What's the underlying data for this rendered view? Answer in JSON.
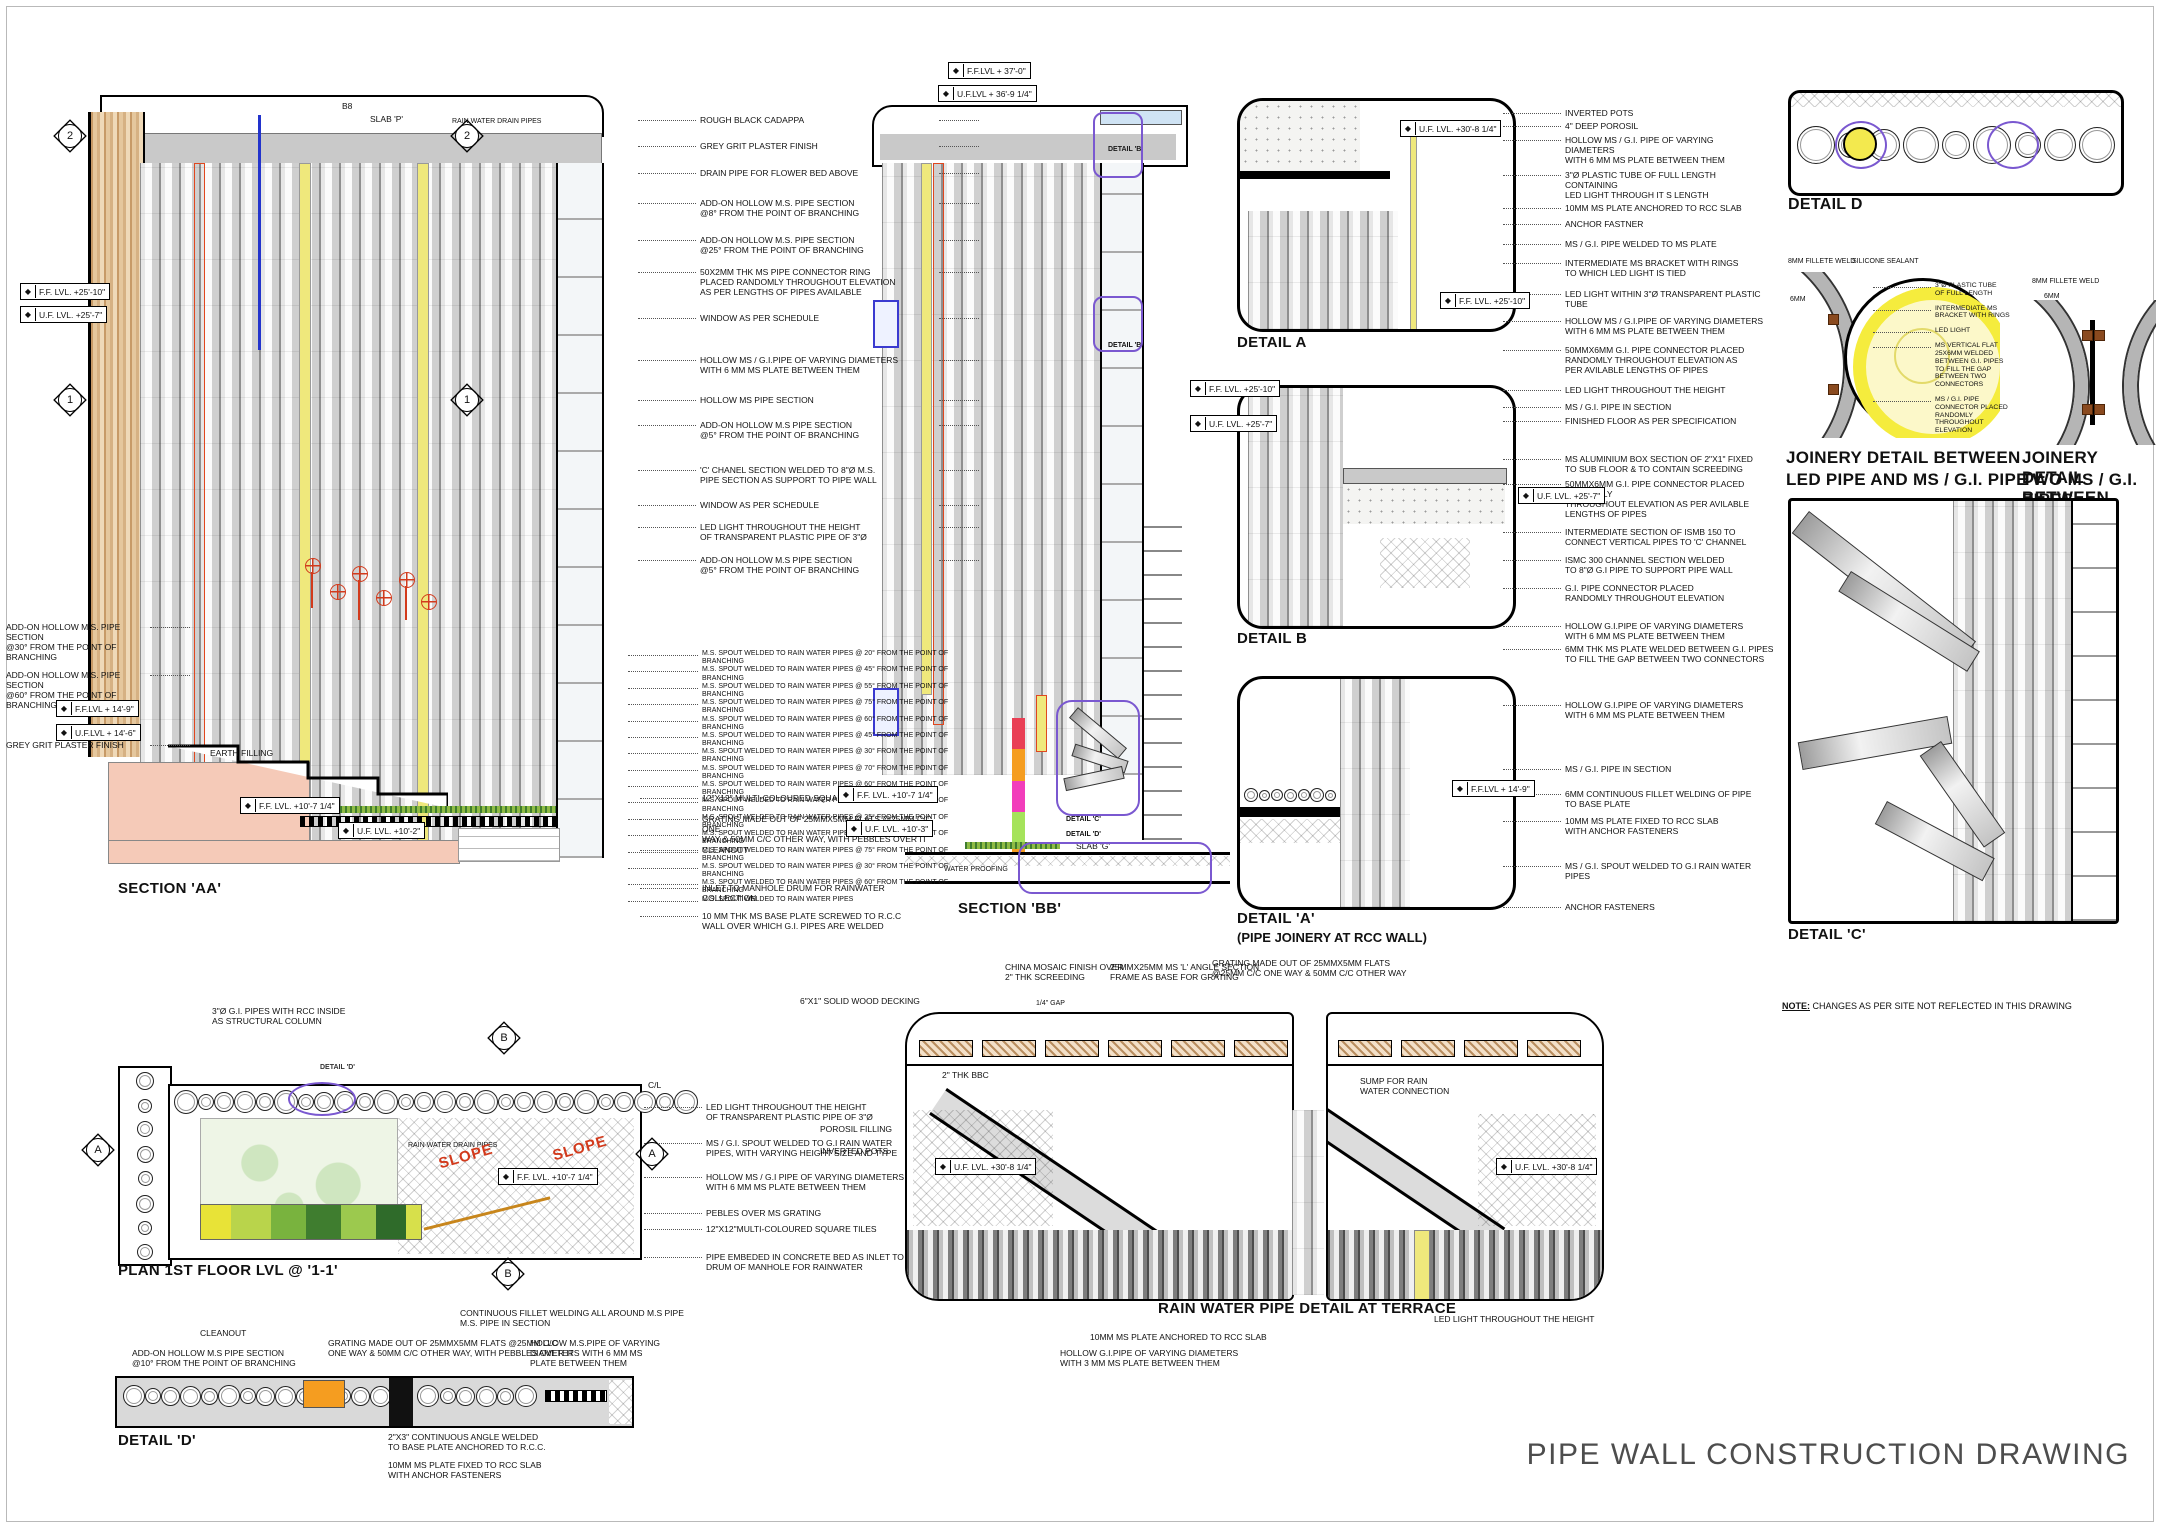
{
  "sheet_title": "PIPE WALL CONSTRUCTION DRAWING",
  "note": {
    "label": "NOTE:",
    "text": " CHANGES AS PER SITE NOT REFLECTED IN THIS DRAWING"
  },
  "titles": {
    "aa": "SECTION 'AA'",
    "bb": "SECTION 'BB'",
    "da": "DETAIL A",
    "db": "DETAIL B",
    "da2": "DETAIL 'A'",
    "da2_sub": "(PIPE JOINERY AT RCC WALL)",
    "dd": "DETAIL D",
    "j1a": "JOINERY DETAIL BETWEEN",
    "j1b": "LED PIPE AND MS / G.I. PIPE",
    "j2a": "JOINERY DETAIL BETWEEN",
    "j2b": "TWO MS / G.I. PIPES",
    "dc": "DETAIL 'C'",
    "plan": "PLAN 1ST FLOOR LVL @ '1-1'",
    "dd2": "DETAIL 'D'",
    "terrace": "RAIN WATER PIPE DETAIL AT TERRACE"
  },
  "marks": {
    "m1": "1",
    "m2": "2",
    "a": "A",
    "b": "B"
  },
  "levels": {
    "ff2510": "F.F. LVL.  +25'-10\"",
    "uf257": "U.F. LVL.  +25'-7\"",
    "ff149": "F.F.LVL + 14'-9\"",
    "uf146": "U.F.LVL + 14'-6\"",
    "ff107": "F.F. LVL.  +10'-7 1/4\"",
    "uf102": "U.F. LVL.  +10'-2\"",
    "uf103": "U.F. LVL.  +10'-3\"",
    "ff370": "F.F.LVL + 37'-0\"",
    "uf369": "U.F.LVL + 36'-9 1/4\"",
    "uf308": "U.F. LVL.  +30'-8 1/4\""
  },
  "labels": {
    "b8": "B8",
    "slab_p": "SLAB 'P'",
    "slab_g": "SLAB 'G'",
    "rwdp": "RAIN WATER DRAIN PIPES",
    "earth": "EARTH FILLING",
    "water_proofing": "WATER PROOFING",
    "detail_b_ref": "DETAIL 'B'",
    "detail_c_ref": "DETAIL 'C'",
    "detail_d_ref": "DETAIL 'D'",
    "cl": "C/L",
    "slope": "SLOPE",
    "col3": "3\"Ø G.I. PIPES WITH RCC INSIDE\nAS STRUCTURAL COLUMN",
    "jl1": "8MM FILLETE WELD",
    "jl2": "SILICONE SEALANT",
    "jl3": "6MM",
    "jr1": "8MM FILLETE WELD",
    "jr2": "6MM",
    "dd2_cleanout": "CLEANOUT",
    "dd2_addon": "ADD-ON HOLLOW M.S PIPE SECTION\n@10° FROM THE POINT OF BRANCHING",
    "dd2_grating": "GRATING MADE OUT OF 25MMX5MM FLATS @25MM C/C\nONE WAY & 50MM C/C OTHER WAY, WITH PEBBLES OVER IT",
    "dd2_fillet": "CONTINUOUS FILLET WELDING ALL AROUND  M.S PIPE\nM.S. PIPE IN SECTION",
    "dd2_hollow": "HOLLOW  M.S.PIPE OF VARYING\nDIAMETERS WITH 6 MM MS\nPLATE BETWEEN THEM",
    "dd2_angle": "2\"X3\" CONTINUOUS ANGLE WELDED\nTO BASE PLATE ANCHORED TO R.C.C.",
    "dd2_plate": "10MM MS PLATE FIXED TO RCC SLAB\nWITH ANCHOR FASTENERS",
    "t_deck": "6\"X1\" SOLID WOOD DECKING",
    "t_mosaic": "CHINA MOSAIC FINISH OVER\n2\" THK SCREEDING",
    "t_gap": "1/4\" GAP",
    "t_angle": "25MMX25MM MS 'L' ANGLE SECTION\nFRAME AS BASE FOR GRATING",
    "t_grating": "GRATING MADE OUT OF 25MMX5MM FLATS\n@25MM C/C ONE WAY & 50MM C/C OTHER WAY",
    "t_bbc": "2\" THK BBC",
    "t_porosil": "POROSIL FILLING",
    "t_pots": "INVERTED POTS",
    "t_sump": "SUMP FOR RAIN\nWATER CONNECTION",
    "t_plate": "10MM MS PLATE ANCHORED TO RCC SLAB",
    "t_hollow": "HOLLOW  G.I.PIPE OF VARYING DIAMETERS\nWITH 3 MM MS PLATE BETWEEN THEM",
    "t_led": "LED LIGHT THROUGHOUT THE HEIGHT"
  },
  "ann": {
    "aa_right": [
      "ROUGH BLACK CADAPPA",
      "GREY GRIT PLASTER FINISH",
      "DRAIN PIPE FOR FLOWER BED ABOVE",
      "ADD-ON HOLLOW M.S. PIPE SECTION\n@8° FROM THE POINT OF BRANCHING",
      "ADD-ON HOLLOW M.S. PIPE SECTION\n@25° FROM THE POINT OF BRANCHING",
      "50X2MM THK MS PIPE CONNECTOR RING\nPLACED RANDOMLY THROUGHOUT ELEVATION\nAS PER LENGTHS OF PIPES AVAILABLE",
      "WINDOW AS PER SCHEDULE",
      "HOLLOW  MS / G.I.PIPE OF VARYING DIAMETERS\nWITH 6 MM MS PLATE BETWEEN THEM",
      "HOLLOW  MS PIPE SECTION",
      "ADD-ON HOLLOW M.S PIPE SECTION\n@5° FROM THE POINT OF BRANCHING",
      "'C' CHANEL SECTION WELDED TO 8\"Ø M.S.\nPIPE SECTION AS SUPPORT TO PIPE WALL",
      "WINDOW AS PER SCHEDULE",
      "LED LIGHT THROUGHOUT THE HEIGHT\nOF TRANSPARENT PLASTIC PIPE OF 3\"Ø",
      "ADD-ON HOLLOW M.S PIPE SECTION\n@5° FROM THE POINT OF BRANCHING"
    ],
    "aa_spouts": [
      "M.S. SPOUT WELDED TO RAIN WATER PIPES @ 20° FROM THE POINT OF BRANCHING",
      "M.S. SPOUT WELDED TO RAIN WATER PIPES @ 45° FROM THE POINT OF BRANCHING",
      "M.S. SPOUT WELDED TO RAIN WATER PIPES @ 55° FROM THE POINT OF BRANCHING",
      "M.S. SPOUT WELDED TO RAIN WATER PIPES @ 75° FROM THE POINT OF BRANCHING",
      "M.S. SPOUT WELDED TO RAIN WATER PIPES @ 60° FROM THE POINT OF BRANCHING",
      "M.S. SPOUT WELDED TO RAIN WATER PIPES @ 45° FROM THE POINT OF BRANCHING",
      "M.S. SPOUT WELDED TO RAIN WATER PIPES @ 30° FROM THE POINT OF BRANCHING",
      "M.S. SPOUT WELDED TO RAIN WATER PIPES @ 70° FROM THE POINT OF BRANCHING",
      "M.S. SPOUT WELDED TO RAIN WATER PIPES @ 60° FROM THE POINT OF BRANCHING",
      "M.S. SPOUT WELDED TO RAIN WATER PIPES @ 45° FROM THE POINT OF BRANCHING",
      "M.S. SPOUT WELDED TO RAIN WATER PIPES @ 25° FROM THE POINT OF BRANCHING",
      "M.S. SPOUT WELDED TO RAIN WATER PIPES @ 40° FROM THE POINT OF BRANCHING",
      "M.S. SPOUT WELDED TO RAIN WATER PIPES @ 75° FROM THE POINT OF BRANCHING",
      "M.S. SPOUT WELDED TO RAIN WATER PIPES @ 30° FROM THE POINT OF BRANCHING",
      "M.S. SPOUT WELDED TO RAIN WATER PIPES @ 60° FROM THE POINT OF BRANCHING",
      "M.S. SPOUT WELDED TO RAIN WATER PIPES"
    ],
    "aa_bottom": [
      "12\"X12\" MULTI-COLOURED SQUARE TILES",
      "GRATING MADE OUT OF 25MMX5MM FLATS @25MM C/C ONE\nWAY & 50MM C/C OTHER WAY, WITH PEBBLES OVER IT",
      "CLEANOUT",
      "INLET TO MANHOLE DRUM FOR RAINWATER COLLECTION",
      "10 MM THK MS BASE PLATE SCREWED TO R.C.C\nWALL OVER WHICH G.I. PIPES ARE WELDED"
    ],
    "aa_left": [
      "ADD-ON HOLLOW M.S. PIPE SECTION\n@30° FROM THE POINT OF BRANCHING",
      "ADD-ON HOLLOW M.S. PIPE SECTION\n@60° FROM THE POINT OF BRANCHING",
      "GREY GRIT PLASTER FINISH"
    ],
    "da": [
      "INVERTED POTS",
      "4\" DEEP POROSIL",
      "HOLLOW  MS / G.I. PIPE OF VARYING DIAMETERS\nWITH 6 MM MS PLATE BETWEEN THEM",
      "3\"Ø PLASTIC TUBE OF FULL LENGTH CONTAINING\nLED LIGHT THROUGH IT S LENGTH",
      "10MM MS PLATE ANCHORED TO RCC SLAB",
      "ANCHOR FASTNER",
      "MS / G.I. PIPE WELDED TO MS PLATE",
      "INTERMEDIATE MS BRACKET WITH RINGS\nTO WHICH LED LIGHT IS TIED",
      "LED LIGHT WITHIN 3\"Ø TRANSPARENT PLASTIC TUBE",
      "HOLLOW  MS / G.I.PIPE OF VARYING DIAMETERS\nWITH 6 MM MS PLATE BETWEEN THEM",
      "50MMX6MM G.I. PIPE CONNECTOR PLACED\nRANDOMLY THROUGHOUT ELEVATION AS\nPER AVILABLE LENGTHS OF PIPES"
    ],
    "db": [
      "LED LIGHT THROUGHOUT THE HEIGHT",
      "MS / G.I. PIPE IN SECTION",
      "FINISHED FLOOR AS PER SPECIFICATION",
      "MS ALUMINIUM BOX SECTION OF 2\"X1\" FIXED\nTO SUB FLOOR & TO CONTAIN SCREEDING",
      "50MMX6MM G.I. PIPE CONNECTOR PLACED RANDOMLY\nTHROUGHOUT ELEVATION AS PER AVILABLE LENGTHS OF PIPES",
      "INTERMEDIATE SECTION OF ISMB 150 TO\nCONNECT VERTICAL PIPES TO 'C' CHANNEL",
      "ISMC 300 CHANNEL SECTION WELDED\nTO 8\"Ø G.I PIPE TO SUPPORT PIPE WALL",
      "G.I. PIPE CONNECTOR PLACED\nRANDOMLY THROUGHOUT ELEVATION",
      "HOLLOW  G.I.PIPE OF VARYING DIAMETERS\nWITH 6 MM MS PLATE BETWEEN THEM",
      "6MM THK MS PLATE WELDED BETWEEN G.I. PIPES\nTO FILL THE GAP BETWEEN TWO CONNECTORS"
    ],
    "da2": [
      "HOLLOW  G.I.PIPE OF VARYING DIAMETERS\nWITH 6 MM MS PLATE BETWEEN THEM",
      "MS / G.I. PIPE IN SECTION",
      "6MM CONTINUOUS FILLET WELDING OF PIPE TO BASE PLATE",
      "10MM MS PLATE FIXED TO RCC SLAB\nWITH ANCHOR FASTENERS",
      "MS / G.I. SPOUT WELDED TO G.I RAIN WATER PIPES",
      "ANCHOR FASTENERS"
    ],
    "jmid": [
      "3\"Ø PLASTIC TUBE\nOF FULL LENGTH",
      "INTERMEDIATE MS\nBRACKET WITH RINGS",
      "LED LIGHT",
      "MS VERTICAL FLAT\n25X6MM WELDED\nBETWEEN G.I. PIPES\nTO FILL THE GAP\nBETWEEN TWO\nCONNECTORS",
      "MS / G.I. PIPE\nCONNECTOR PLACED\nRANDOMLY\nTHROUGHOUT\nELEVATION"
    ],
    "plan_right": [
      "LED LIGHT THROUGHOUT THE HEIGHT\nOF TRANSPARENT PLASTIC PIPE OF 3\"Ø",
      "MS / G.I. SPOUT WELDED TO G.I RAIN WATER\nPIPES, WITH VARYING HEIGHT SIZE AND TYPE",
      "HOLLOW  MS / G.I PIPE OF VARYING DIAMETERS\nWITH 6 MM MS PLATE BETWEEN THEM",
      "PEBLES OVER MS GRATING",
      "12\"X12\"MULTI-COLOURED SQUARE TILES",
      "PIPE EMBEDED IN CONCRETE BED AS INLET TO\nDRUM OF MANHOLE FOR RAINWATER"
    ]
  }
}
